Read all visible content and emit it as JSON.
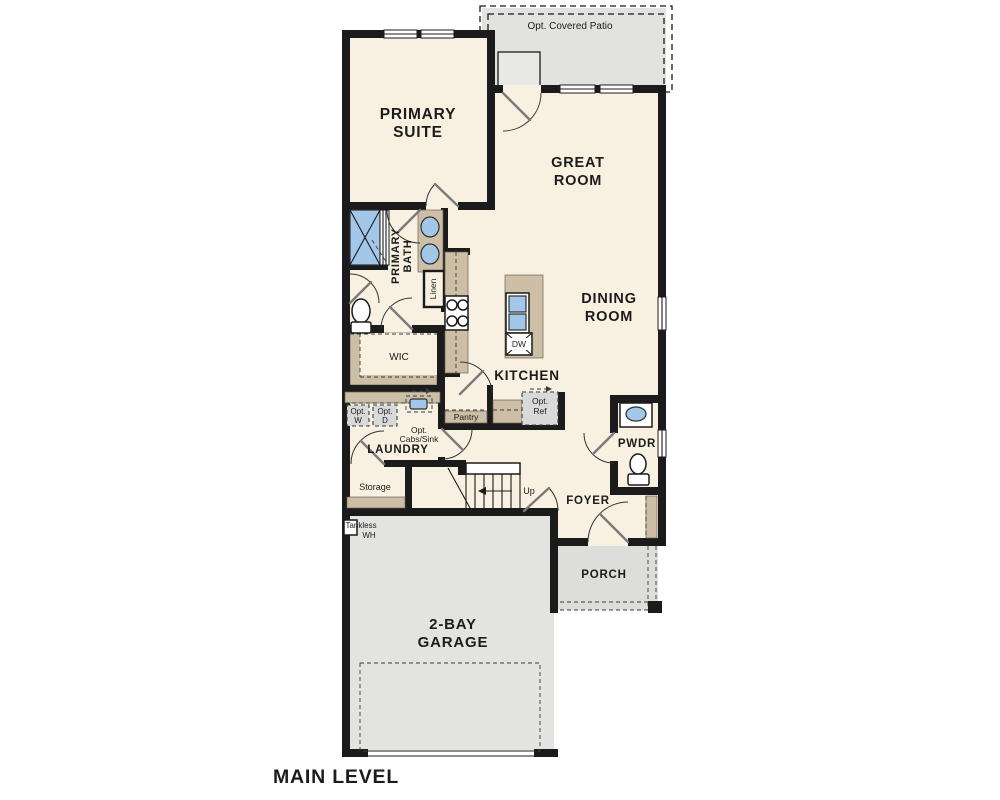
{
  "plan": {
    "title": "MAIN LEVEL",
    "patio": {
      "label": "Opt. Covered Patio"
    },
    "rooms": {
      "primary_suite": {
        "line1": "PRIMARY",
        "line2": "SUITE"
      },
      "great_room": {
        "line1": "GREAT",
        "line2": "ROOM"
      },
      "dining_room": {
        "line1": "DINING",
        "line2": "ROOM"
      },
      "primary_bath": {
        "line1": "PRIMARY",
        "line2": "BATH"
      },
      "wic": {
        "label": "WIC"
      },
      "linen": {
        "label": "Linen"
      },
      "kitchen": {
        "label": "KITCHEN"
      },
      "laundry": {
        "label": "LAUNDRY"
      },
      "storage": {
        "label": "Storage"
      },
      "foyer": {
        "label": "FOYER"
      },
      "pwdr": {
        "label": "PWDR"
      },
      "porch": {
        "label": "PORCH"
      },
      "garage": {
        "line1": "2-BAY",
        "line2": "GARAGE"
      }
    },
    "features": {
      "pantry": {
        "label": "Pantry"
      },
      "dw": {
        "label": "DW"
      },
      "opt_ref": {
        "line1": "Opt.",
        "line2": "Ref"
      },
      "opt_w": {
        "line1": "Opt.",
        "line2": "W"
      },
      "opt_d": {
        "line1": "Opt.",
        "line2": "D"
      },
      "opt_cabs": {
        "line1": "Opt.",
        "line2": "Cabs/Sink"
      },
      "up": {
        "label": "Up"
      },
      "tankless": {
        "line1": "Tankless",
        "line2": "WH"
      }
    },
    "colors": {
      "floor": "#f8f0e1",
      "concrete": "#e2e2e0",
      "cabinet": "#ccbfa6",
      "fixture_blue": "#a3c7e8",
      "wall": "#1b1b1b",
      "option_box": "#d9d9d9"
    }
  }
}
